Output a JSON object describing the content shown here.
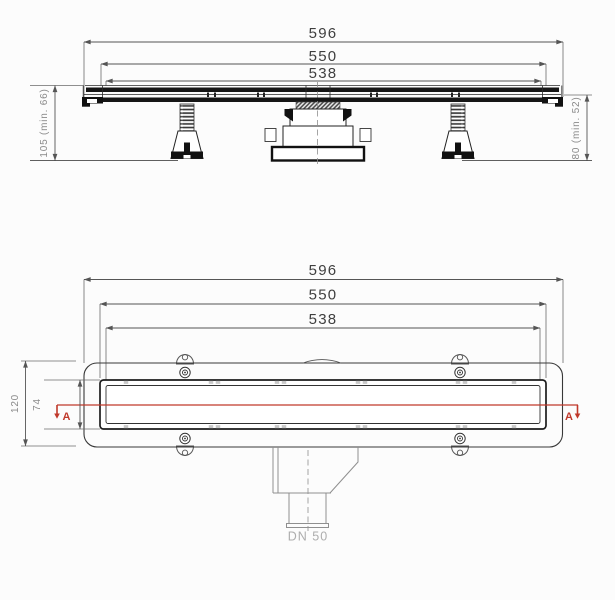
{
  "colors": {
    "line": "#2b2b2b",
    "heavy": "#111111",
    "dim_line": "#555555",
    "dim_text": "#3f3f3f",
    "gray_text": "#8a8a8a",
    "light_text": "#adadad",
    "section_red": "#c0392b",
    "bg": "#fcfcfc"
  },
  "side_view": {
    "dim_596": "596",
    "dim_550": "550",
    "dim_538": "538",
    "dim_height_left": "105 (min. 66)",
    "dim_height_right": "80 (min. 52)"
  },
  "plan_view": {
    "dim_596": "596",
    "dim_550": "550",
    "dim_538": "538",
    "dim_height": "120",
    "dim_inner_height": "74",
    "section_label_left": "A",
    "section_label_right": "A",
    "outlet_label": "DN 50"
  }
}
